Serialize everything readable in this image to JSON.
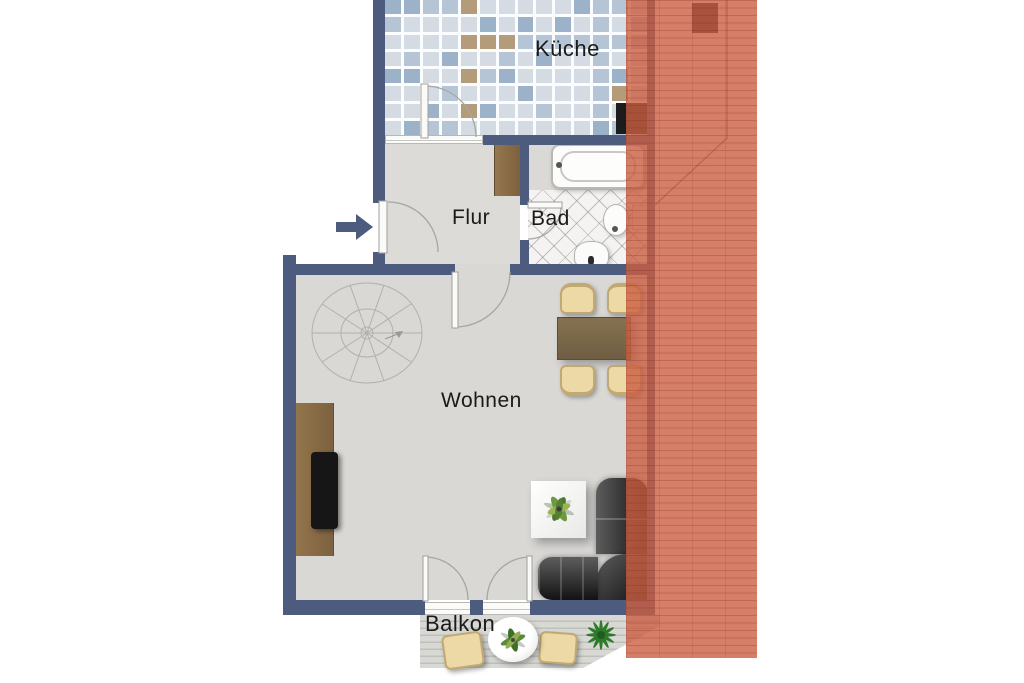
{
  "plan": {
    "title": "apartment-floor-plan",
    "rooms": {
      "kueche": {
        "label": "Küche"
      },
      "flur": {
        "label": "Flur"
      },
      "bad": {
        "label": "Bad"
      },
      "wohnen": {
        "label": "Wohnen"
      },
      "balkon": {
        "label": "Balkon"
      }
    },
    "icons": {
      "entrance": "arrow-right-icon",
      "stairs": "spiral-staircase",
      "roof": "roof-overlay"
    }
  },
  "colors": {
    "wall": "#4d5c7e",
    "roof": "#cb5e42",
    "roof_line": "#a84a30",
    "grout": "#fbfcfd",
    "tile_light": "#d4dbe2",
    "tile_mid": "#b6c5d5",
    "tile_dark": "#9cb2c8",
    "tile_accent": "#b49b79",
    "floor": "#dcdbd8",
    "floor_living": "#d9d8d5",
    "bad_floor": "#f4f3f1",
    "balcony_floor": "#d8d8d5",
    "plank_line": "#bfbfbc",
    "wood": "#8a6e4a",
    "table": "#756348",
    "chair": "#ecd9a6",
    "chair_border": "#c2a873",
    "sofa_dark": "#161616",
    "sofa_light": "#5d5d5d",
    "plant_green": "#3f7a2e",
    "fixture_border": "#b5b3b0",
    "label": "#1a1a1a"
  }
}
